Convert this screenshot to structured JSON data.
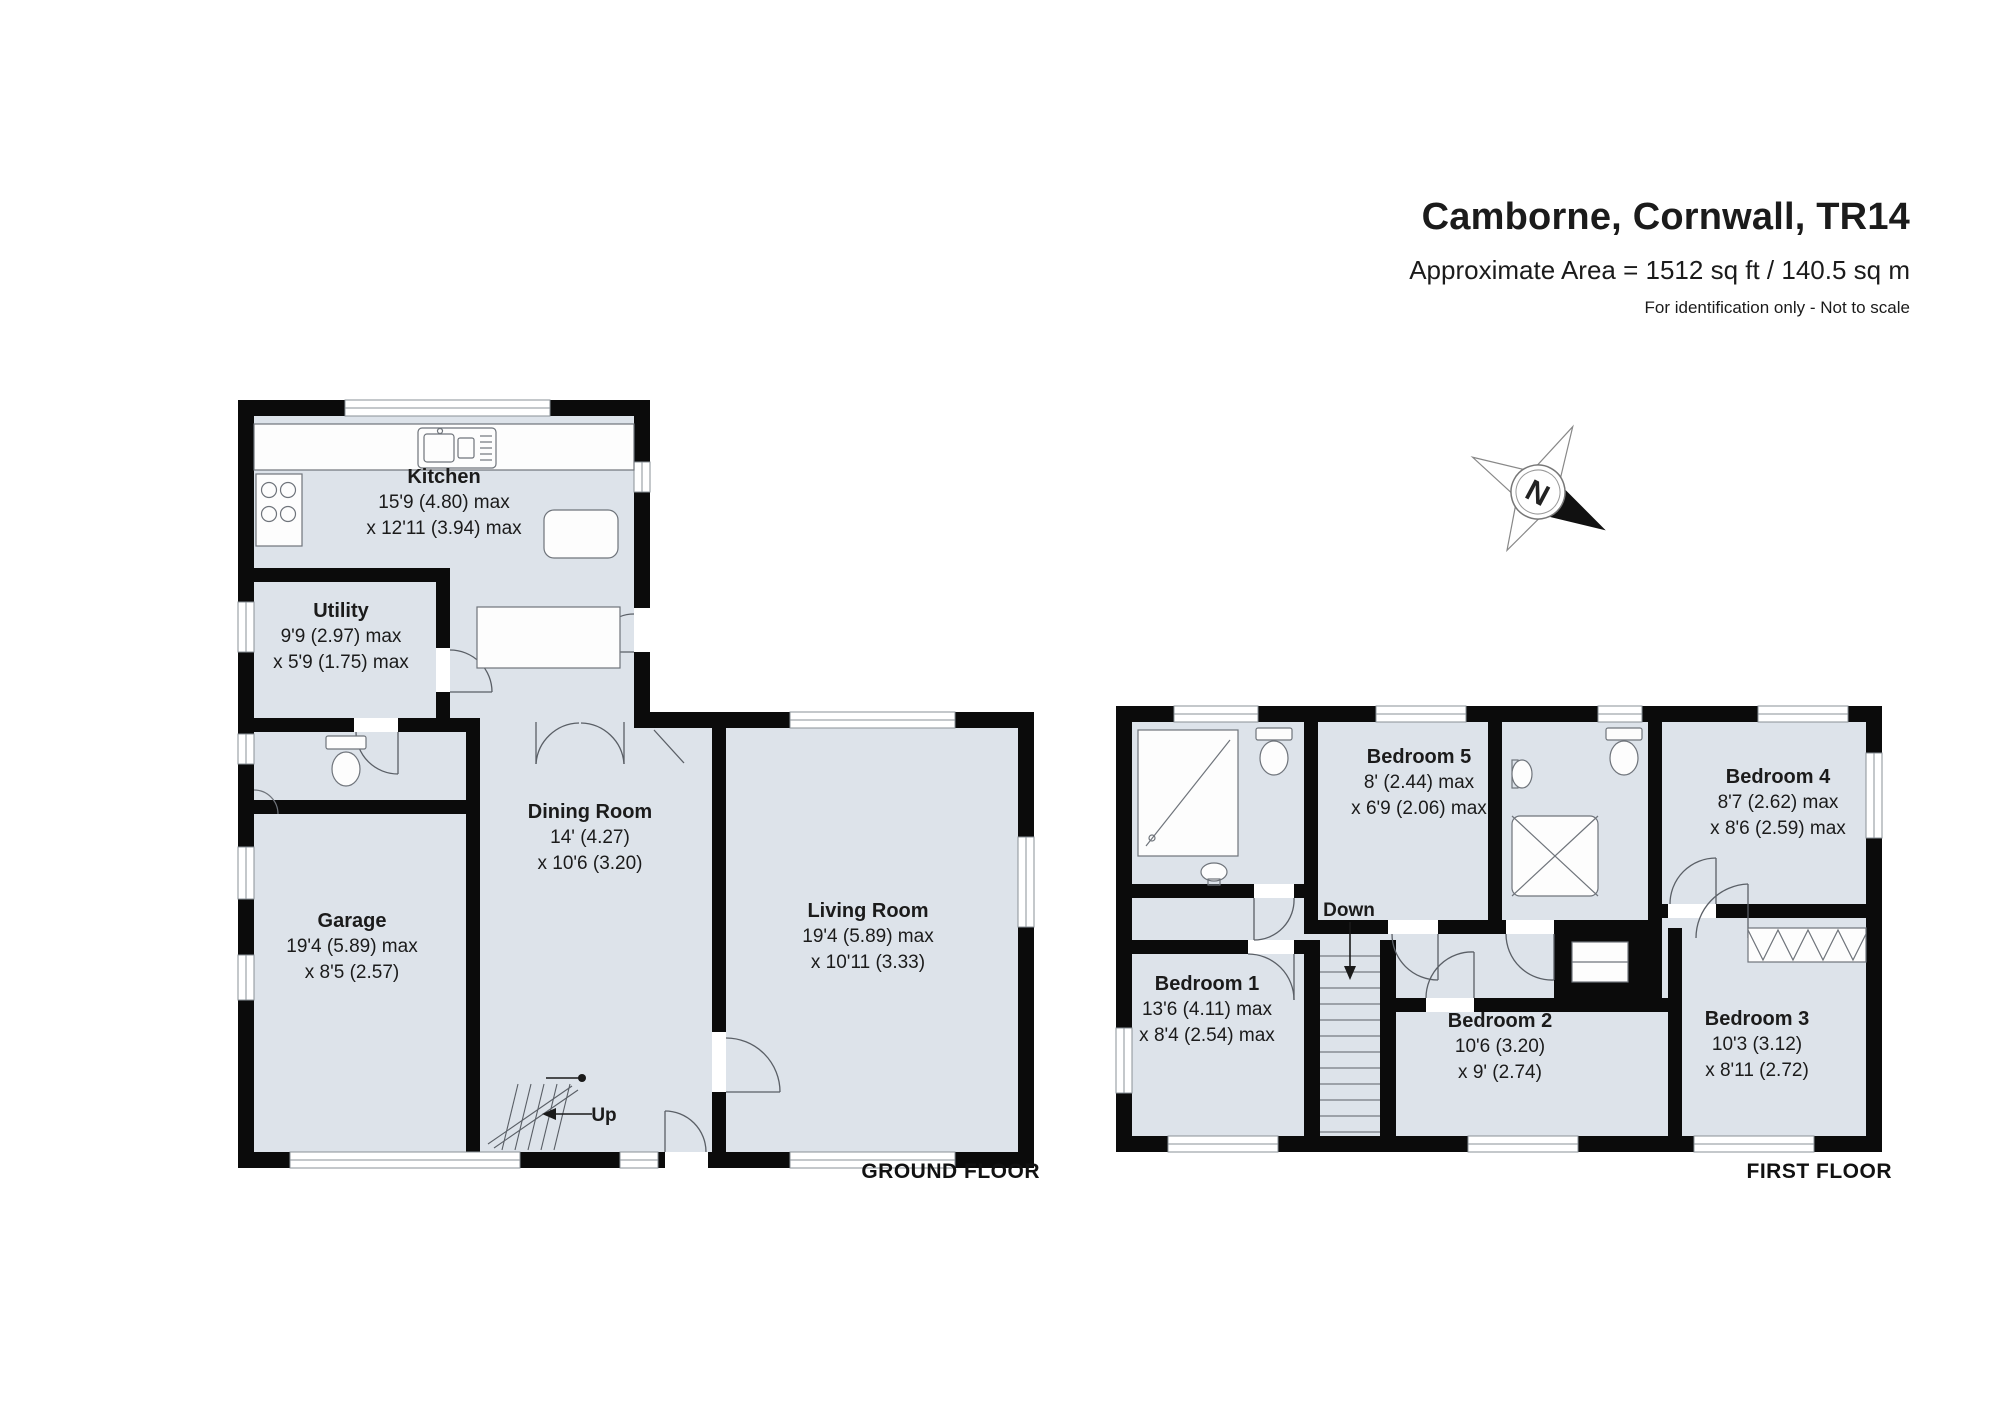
{
  "header": {
    "title": "Camborne, Cornwall, TR14",
    "area_line": "Approximate Area = 1512 sq ft / 140.5 sq m",
    "note": "For identification only - Not to scale"
  },
  "compass": {
    "north_label": "N"
  },
  "colors": {
    "wall": "#0b0b0b",
    "floor_fill": "#dde3ea",
    "background": "#ffffff"
  },
  "ground_floor": {
    "label": "GROUND FLOOR",
    "stair_label": "Up",
    "rooms": {
      "kitchen": {
        "name": "Kitchen",
        "dim1": "15'9 (4.80) max",
        "dim2": "x 12'11 (3.94) max"
      },
      "utility": {
        "name": "Utility",
        "dim1": "9'9 (2.97) max",
        "dim2": "x 5'9 (1.75) max"
      },
      "garage": {
        "name": "Garage",
        "dim1": "19'4 (5.89) max",
        "dim2": "x 8'5 (2.57)"
      },
      "dining": {
        "name": "Dining Room",
        "dim1": "14' (4.27)",
        "dim2": "x 10'6 (3.20)"
      },
      "living": {
        "name": "Living Room",
        "dim1": "19'4 (5.89) max",
        "dim2": "x 10'11 (3.33)"
      }
    }
  },
  "first_floor": {
    "label": "FIRST FLOOR",
    "stair_label": "Down",
    "rooms": {
      "bedroom1": {
        "name": "Bedroom 1",
        "dim1": "13'6 (4.11) max",
        "dim2": "x 8'4 (2.54) max"
      },
      "bedroom2": {
        "name": "Bedroom 2",
        "dim1": "10'6 (3.20)",
        "dim2": "x 9' (2.74)"
      },
      "bedroom3": {
        "name": "Bedroom 3",
        "dim1": "10'3 (3.12)",
        "dim2": "x 8'11 (2.72)"
      },
      "bedroom4": {
        "name": "Bedroom 4",
        "dim1": "8'7 (2.62) max",
        "dim2": "x 8'6 (2.59) max"
      },
      "bedroom5": {
        "name": "Bedroom 5",
        "dim1": "8' (2.44) max",
        "dim2": "x 6'9 (2.06) max"
      }
    }
  }
}
